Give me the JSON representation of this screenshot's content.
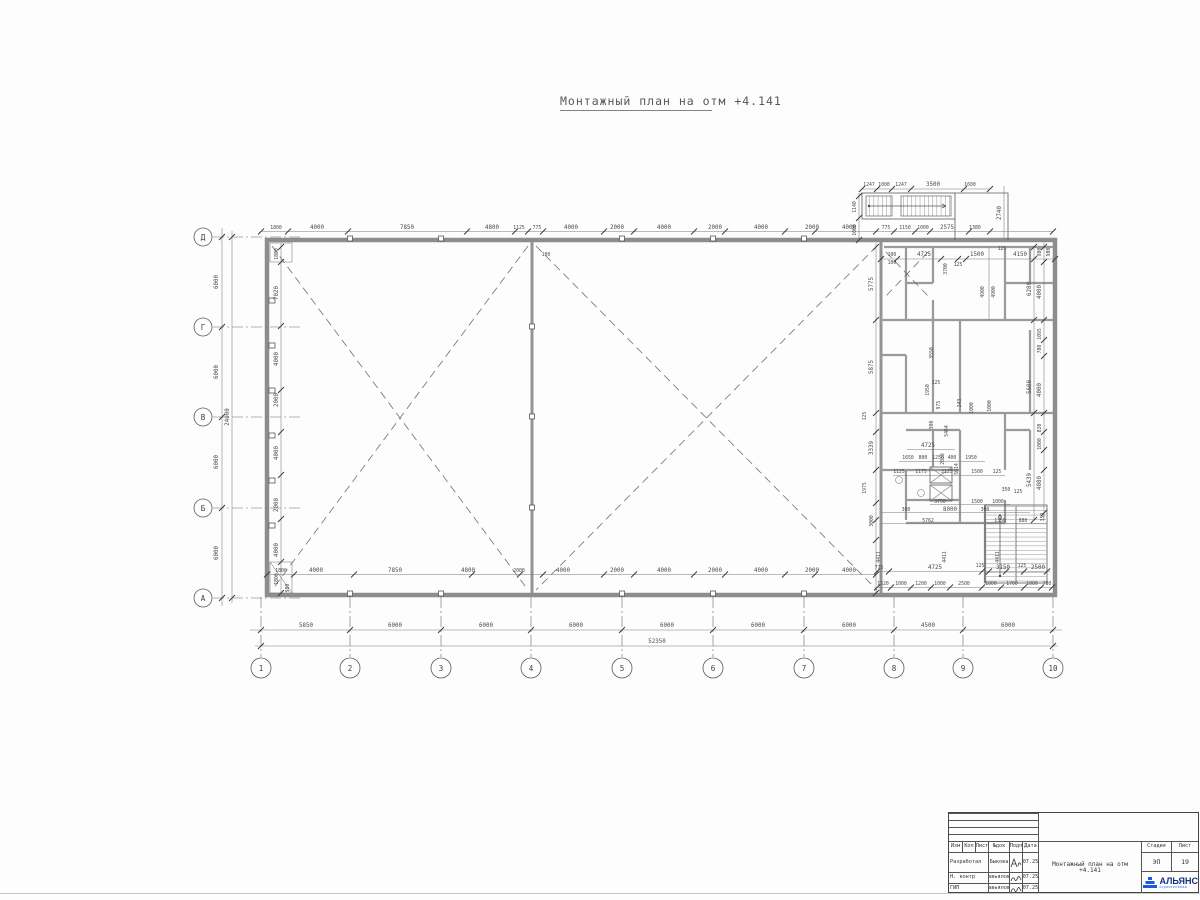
{
  "page": {
    "title": "Монтажный план на отм +4.141"
  },
  "axes": {
    "cols": [
      "1",
      "2",
      "3",
      "4",
      "5",
      "6",
      "7",
      "8",
      "9",
      "10"
    ],
    "rows": [
      "Д",
      "Г",
      "В",
      "Б",
      "А"
    ]
  },
  "dims": {
    "bottom_axis": [
      "5850",
      "6000",
      "6000",
      "6000",
      "6000",
      "6000",
      "6000",
      "4500",
      "6000"
    ],
    "bottom_total": "52350",
    "left_axis": [
      "6000",
      "6000",
      "6000",
      "6000"
    ],
    "left_total": "24000",
    "top": [
      "1800",
      "4000",
      "7850",
      "4800",
      "1125",
      "775",
      "4000",
      "2000",
      "4000",
      "2000",
      "4000",
      "2000",
      "4000",
      "775",
      "1150",
      "1000",
      "2575",
      "1380"
    ],
    "topr": [
      "100",
      "4725",
      "3700",
      "125",
      "1500",
      "4150",
      "125",
      "980"
    ],
    "stair": [
      "1247",
      "1000",
      "1247",
      "3500",
      "1600",
      "1140",
      "1000",
      "2740"
    ],
    "leftw": [
      "1800",
      "7020",
      "4000",
      "2000",
      "4000",
      "2000",
      "4000",
      "1800",
      "980"
    ],
    "rightw": [
      "980",
      "6280",
      "4000",
      "1095",
      "780",
      "5600",
      "4000",
      "820",
      "1080",
      "5439",
      "4080",
      "359"
    ],
    "rcol": [
      "5775",
      "5875",
      "3339",
      "1975",
      "3000",
      "4411",
      "4411",
      "4411"
    ],
    "rmid": [
      "4900",
      "4900",
      "3550",
      "5464",
      "5614",
      "1950",
      "975",
      "300",
      "243",
      "1000",
      "1000",
      "2039",
      "4725",
      "125",
      "125"
    ],
    "erow": [
      "1650",
      "800",
      "1250",
      "400",
      "1950"
    ],
    "erow2": [
      "1125",
      "1175",
      "2125",
      "1500",
      "125"
    ],
    "cluster": [
      "3750",
      "1500",
      "1000",
      "350",
      "125",
      "300",
      "8000",
      "300",
      "5762",
      "1350",
      "880"
    ],
    "botl": [
      "1800",
      "4000",
      "7850",
      "4800",
      "2000",
      "4000",
      "2000",
      "4000",
      "2000",
      "4000",
      "2000",
      "4000"
    ],
    "botr1": [
      "775",
      "4725",
      "125",
      "3150",
      "125",
      "2500"
    ],
    "botr2": [
      "1320",
      "1000",
      "1200",
      "1000",
      "2500",
      "1000",
      "1700",
      "1000",
      "780"
    ],
    "marks": [
      "100",
      "100"
    ]
  },
  "title_block": {
    "cols": [
      "Изм",
      "Кол",
      "Лист",
      "№док",
      "Подп",
      "Дата"
    ],
    "rows": [
      {
        "role": "Разработал",
        "name": "Быкова",
        "date": "07.25"
      },
      {
        "role": "Н. контр",
        "name": "Завьялова",
        "date": "07.25"
      },
      {
        "role": "ГИП",
        "name": "Завьялова",
        "date": "07.25"
      }
    ],
    "doc_title": "Монтажный план на отм +4.141",
    "stage_label": "Стадия",
    "stage_value": "ЭП",
    "sheet_label": "Лист",
    "sheet_value": "19",
    "logo_text": "АЛЬЯНС",
    "logo_sub": "строительная"
  },
  "colors": {
    "logo_blue": "#1d5bd8",
    "logo_dark": "#15317e",
    "line_gray": "#8d8d8d"
  }
}
